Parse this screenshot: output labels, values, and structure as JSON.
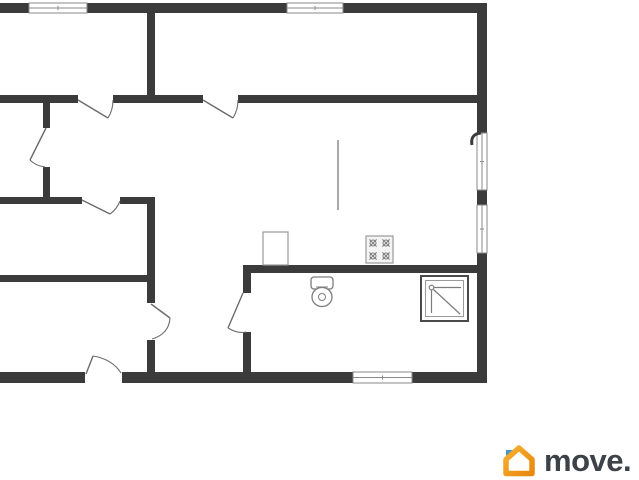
{
  "meta": {
    "background": "#ffffff",
    "wall_color": "#3b3b3b",
    "door_line_color": "#6b6b6b",
    "fixture_line_color": "#7d7d7d",
    "window_frame_color": "#8a8a8a"
  },
  "plan": {
    "walls": [
      [
        0,
        3,
        29,
        10
      ],
      [
        87,
        3,
        200,
        10
      ],
      [
        343,
        3,
        144,
        10
      ],
      [
        477,
        13,
        10,
        120
      ],
      [
        477,
        190,
        10,
        15
      ],
      [
        477,
        253,
        10,
        130
      ],
      [
        0,
        372,
        85,
        11
      ],
      [
        122,
        372,
        231,
        11
      ],
      [
        412,
        372,
        75,
        11
      ],
      [
        147,
        13,
        8,
        82
      ],
      [
        0,
        95,
        78,
        8
      ],
      [
        113,
        95,
        90,
        8
      ],
      [
        238,
        95,
        239,
        8
      ],
      [
        43,
        103,
        7,
        25
      ],
      [
        43,
        167,
        7,
        30
      ],
      [
        0,
        197,
        82,
        7
      ],
      [
        120,
        197,
        32,
        7
      ],
      [
        147,
        197,
        8,
        85
      ],
      [
        0,
        275,
        147,
        7
      ],
      [
        147,
        282,
        8,
        21
      ],
      [
        147,
        340,
        8,
        32
      ],
      [
        243,
        265,
        234,
        8
      ],
      [
        243,
        273,
        8,
        20
      ],
      [
        243,
        332,
        8,
        40
      ]
    ],
    "windows": [
      {
        "x": 29,
        "y": 3,
        "w": 58,
        "h": 10,
        "o": "h"
      },
      {
        "x": 287,
        "y": 3,
        "w": 56,
        "h": 10,
        "o": "h"
      },
      {
        "x": 477,
        "y": 133,
        "w": 10,
        "h": 57,
        "o": "v"
      },
      {
        "x": 477,
        "y": 205,
        "w": 10,
        "h": 48,
        "o": "v"
      },
      {
        "x": 353,
        "y": 372,
        "w": 59,
        "h": 11,
        "o": "h"
      }
    ],
    "doors": [
      {
        "leaf": [
          78,
          100,
          108,
          118
        ],
        "arc": "M108,118 Q113,110 113,100"
      },
      {
        "leaf": [
          203,
          100,
          233,
          118
        ],
        "arc": "M233,118 Q238,110 238,100"
      },
      {
        "leaf": [
          46,
          128,
          30,
          160
        ],
        "arc": "M30,160 Q36,166 45,167"
      },
      {
        "leaf": [
          82,
          200,
          110,
          214
        ],
        "arc": "M110,214 Q117,209 120,201"
      },
      {
        "leaf": [
          151,
          304,
          170,
          318
        ],
        "arc": "M170,318 Q169,334 152,339"
      },
      {
        "leaf": [
          86,
          374,
          93,
          356
        ],
        "arc": "M93,356 Q112,359 121,373"
      },
      {
        "leaf": [
          243,
          293,
          228,
          328
        ],
        "arc": "M228,328 Q238,334 246,332"
      }
    ],
    "balcony_arc": "M481,133 Q470,134 472,145",
    "divider": {
      "x1": 338,
      "y1": 140,
      "x2": 338,
      "y2": 210
    },
    "fixtures": [
      {
        "type": "cabinet",
        "rect": [
          263,
          232,
          25,
          33
        ]
      },
      {
        "type": "stove",
        "rect": [
          366,
          236,
          27,
          27
        ],
        "burners": [
          [
            373,
            243
          ],
          [
            386,
            243
          ],
          [
            373,
            256
          ],
          [
            386,
            256
          ]
        ]
      },
      {
        "type": "toilet",
        "tank": [
          311,
          277,
          22,
          12
        ],
        "tank_line": [
          316,
          287,
          328,
          287
        ],
        "bowl": [
          322,
          297,
          10,
          9.5
        ],
        "inner_r": 3.5
      },
      {
        "type": "shower",
        "outer": [
          421,
          276,
          47,
          45
        ],
        "inner": [
          425.5,
          280.5,
          38,
          36
        ],
        "head": [
          431.5,
          287.5,
          2.3
        ],
        "lines": [
          [
            431.5,
            290,
            431.5,
            313
          ],
          [
            434,
            287.5,
            461,
            287.5
          ],
          [
            433.5,
            289.5,
            460,
            314
          ]
        ]
      }
    ]
  },
  "watermark": {
    "brand": "move.",
    "icon": "house-icon",
    "orange_light": "#f7b032",
    "orange_dark": "#e8880b",
    "blue": "#4a94cc",
    "text_color": "#3c4247"
  }
}
